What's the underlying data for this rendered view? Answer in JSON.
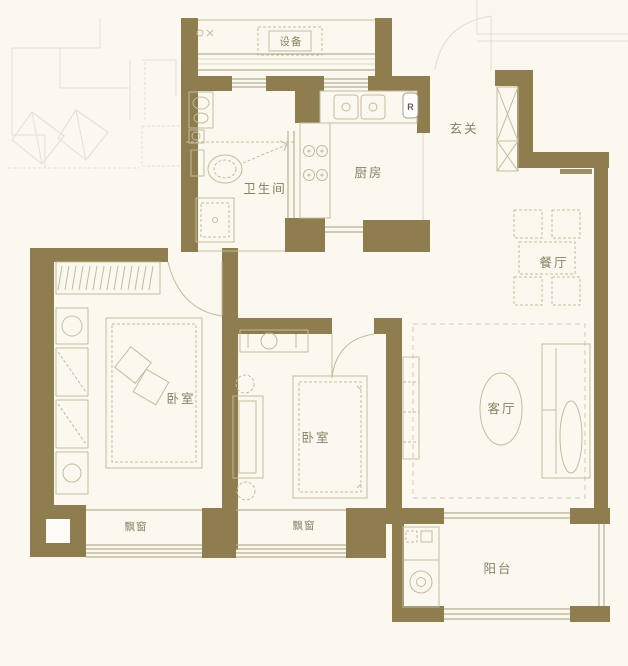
{
  "colors": {
    "background": "#fbf8f0",
    "wall": "#8e7d4f",
    "furniture": "#c5bb9e",
    "window": "#b9ae8f",
    "label": "#8a7f63",
    "faint": "#e2ded2"
  },
  "labels": {
    "equipment": "设备",
    "entry": "玄关",
    "kitchen": "厨房",
    "bathroom": "卫生间",
    "dining": "餐厅",
    "master_bedroom": "卧室",
    "second_bedroom": "卧室",
    "living_room": "客厅",
    "bay_window_master": "飘窗",
    "bay_window_second": "飘窗",
    "balcony": "阳台",
    "fridge_marker": "R"
  }
}
